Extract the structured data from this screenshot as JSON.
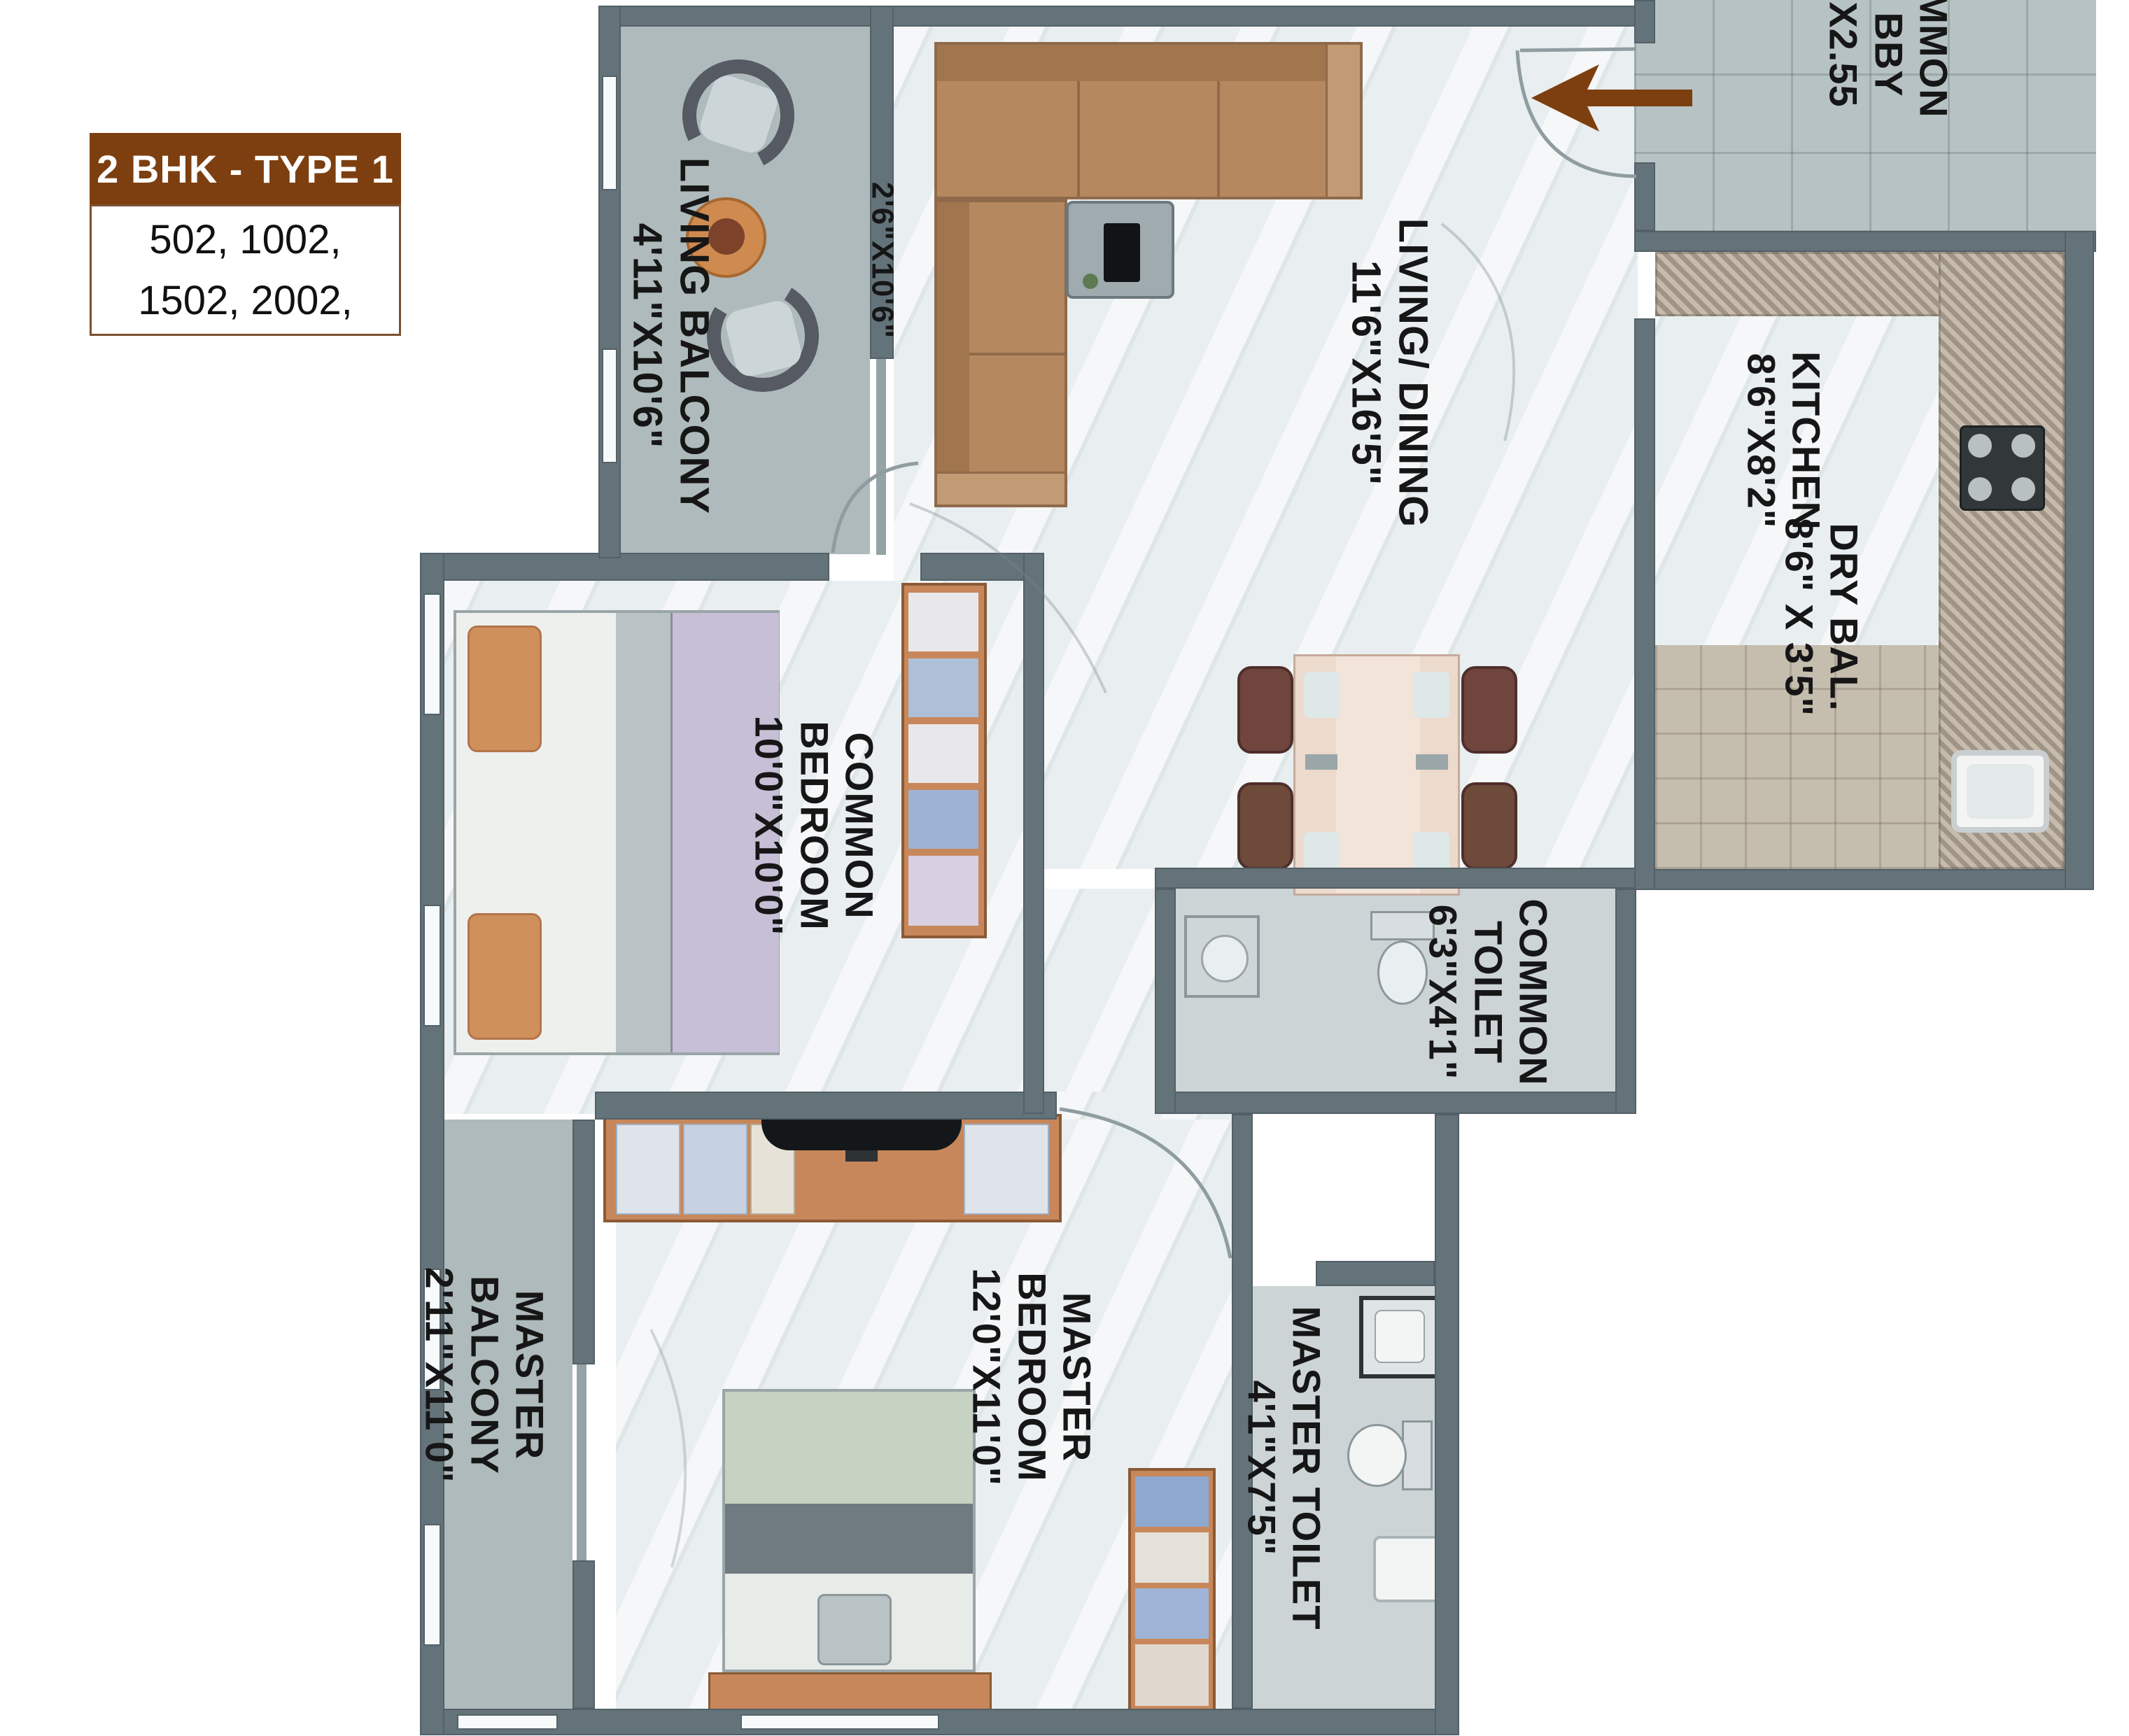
{
  "header": {
    "title": "2 BHK - TYPE 1",
    "units": "502, 1002,\n1502, 2002,"
  },
  "rooms": {
    "living_balcony": "LIVING BALCONY\n4'11\"X10'6\"",
    "passage_dim": "2'6\"X10'6\"",
    "living_dining": "LIVING/ DINING\n11'6\"X16'5\"",
    "kitchen": "KITCHEN\n8'6\"X8'2\"",
    "dry_balcony": "DRY BAL.\n8'6\" X 3'5\"",
    "common_bedroom": "COMMON\nBEDROOM\n10'0\"X10'0\"",
    "common_toilet": "COMMON\nTOILET\n6'3\"X4'1\"",
    "master_bedroom": "MASTER\nBEDROOM\n12'0\"X11'0\"",
    "master_balcony": "MASTER\nBALCONY\n2'11\"X11'0\"",
    "master_toilet": "MASTER TOILET\n4'1\"X7'5\"",
    "lobby": "MMON\nBBY\nX2.55"
  },
  "colors": {
    "accent_brown": "#7d3f10",
    "wall_gray": "#64737a",
    "floor_light": "#e9eef0",
    "balcony_floor": "#aebabb",
    "counter_granite": "#b6aa9c",
    "sofa_tan": "#b5885f",
    "wood_orange": "#c8875a",
    "label_text": "#161616"
  }
}
